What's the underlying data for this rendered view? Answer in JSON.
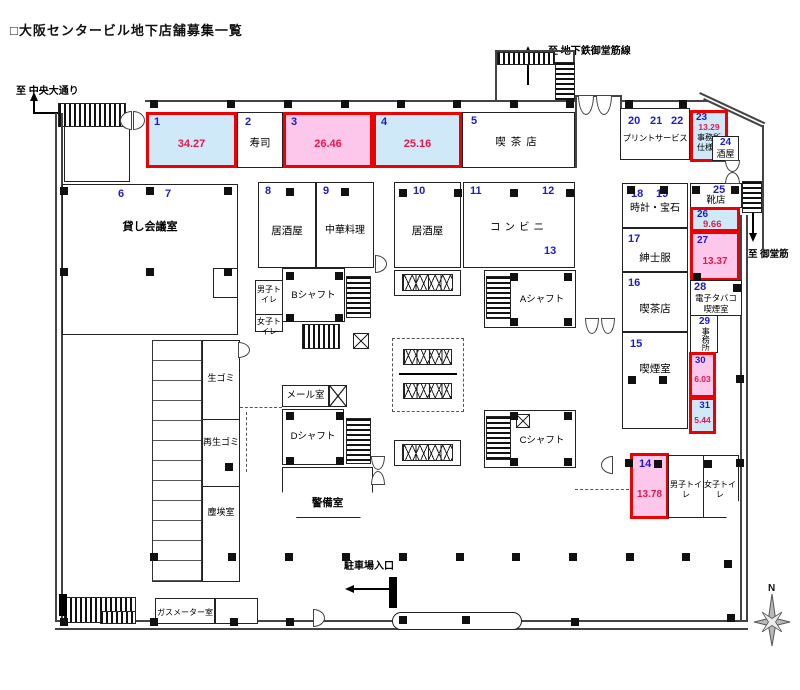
{
  "title": "□大阪センタービル地下店舗募集一覧",
  "directions": {
    "chuo_odori": "至 中央大通り",
    "subway_midosuji_line": "至 地下鉄御堂筋線",
    "midosuji": "至 御堂筋",
    "parking_entrance": "駐車場入口",
    "north": "N"
  },
  "units": {
    "u1": {
      "no": "1",
      "area": "34.27"
    },
    "u2": {
      "no": "2",
      "name": "寿司"
    },
    "u3": {
      "no": "3",
      "area": "26.46"
    },
    "u4": {
      "no": "4",
      "area": "25.16"
    },
    "u5": {
      "no": "5",
      "name": "喫茶店"
    },
    "u6": {
      "no": "6"
    },
    "u7": {
      "no": "7",
      "name": "貸し会議室"
    },
    "u8": {
      "no": "8",
      "name": "居酒屋"
    },
    "u9": {
      "no": "9",
      "name": "中華料理"
    },
    "u10": {
      "no": "10",
      "name": "居酒屋"
    },
    "u11": {
      "no": "11"
    },
    "u12": {
      "no": "12",
      "name": "コンビニ"
    },
    "u13": {
      "no": "13"
    },
    "u14": {
      "no": "14",
      "area": "13.78"
    },
    "u15": {
      "no": "15",
      "name": "喫煙室"
    },
    "u16": {
      "no": "16",
      "name": "喫茶店"
    },
    "u17": {
      "no": "17",
      "name": "紳士服"
    },
    "u18": {
      "no": "18"
    },
    "u19": {
      "no": "19",
      "name": "時計・宝石"
    },
    "u20": {
      "no": "20"
    },
    "u21": {
      "no": "21"
    },
    "u22": {
      "no": "22",
      "name": "プリントサービス"
    },
    "u23": {
      "no": "23",
      "area": "13.29",
      "note": "事務所仕様"
    },
    "u24": {
      "no": "24",
      "name": "酒屋"
    },
    "u25": {
      "no": "25",
      "name": "靴店"
    },
    "u26": {
      "no": "26",
      "area": "9.66"
    },
    "u27": {
      "no": "27",
      "area": "13.37"
    },
    "u28": {
      "no": "28",
      "name": "電子タバコ喫煙室"
    },
    "u29": {
      "no": "29",
      "name": "事務所"
    },
    "u30": {
      "no": "30",
      "area": "6.03"
    },
    "u31": {
      "no": "31",
      "area": "5.44"
    }
  },
  "facilities": {
    "shaft_a": "Aシャフト",
    "shaft_b": "Bシャフト",
    "shaft_c": "Cシャフト",
    "shaft_d": "Dシャフト",
    "mail_room": "メール室",
    "security_room": "警備室",
    "mens_toilet": "男子トイレ",
    "womens_toilet": "女子トイレ",
    "raw_garbage": "生ゴミ",
    "recycled_garbage": "再生ゴミ",
    "dust_room": "塵埃室",
    "gas_meter_room": "ガスメーター室"
  },
  "colors": {
    "vacant_blue": "#cfe9f8",
    "vacant_pink": "#fcc7ea",
    "highlight_red": "#ee0000",
    "unit_number_blue": "#1c1ccd",
    "area_value_red": "#e8184b"
  }
}
